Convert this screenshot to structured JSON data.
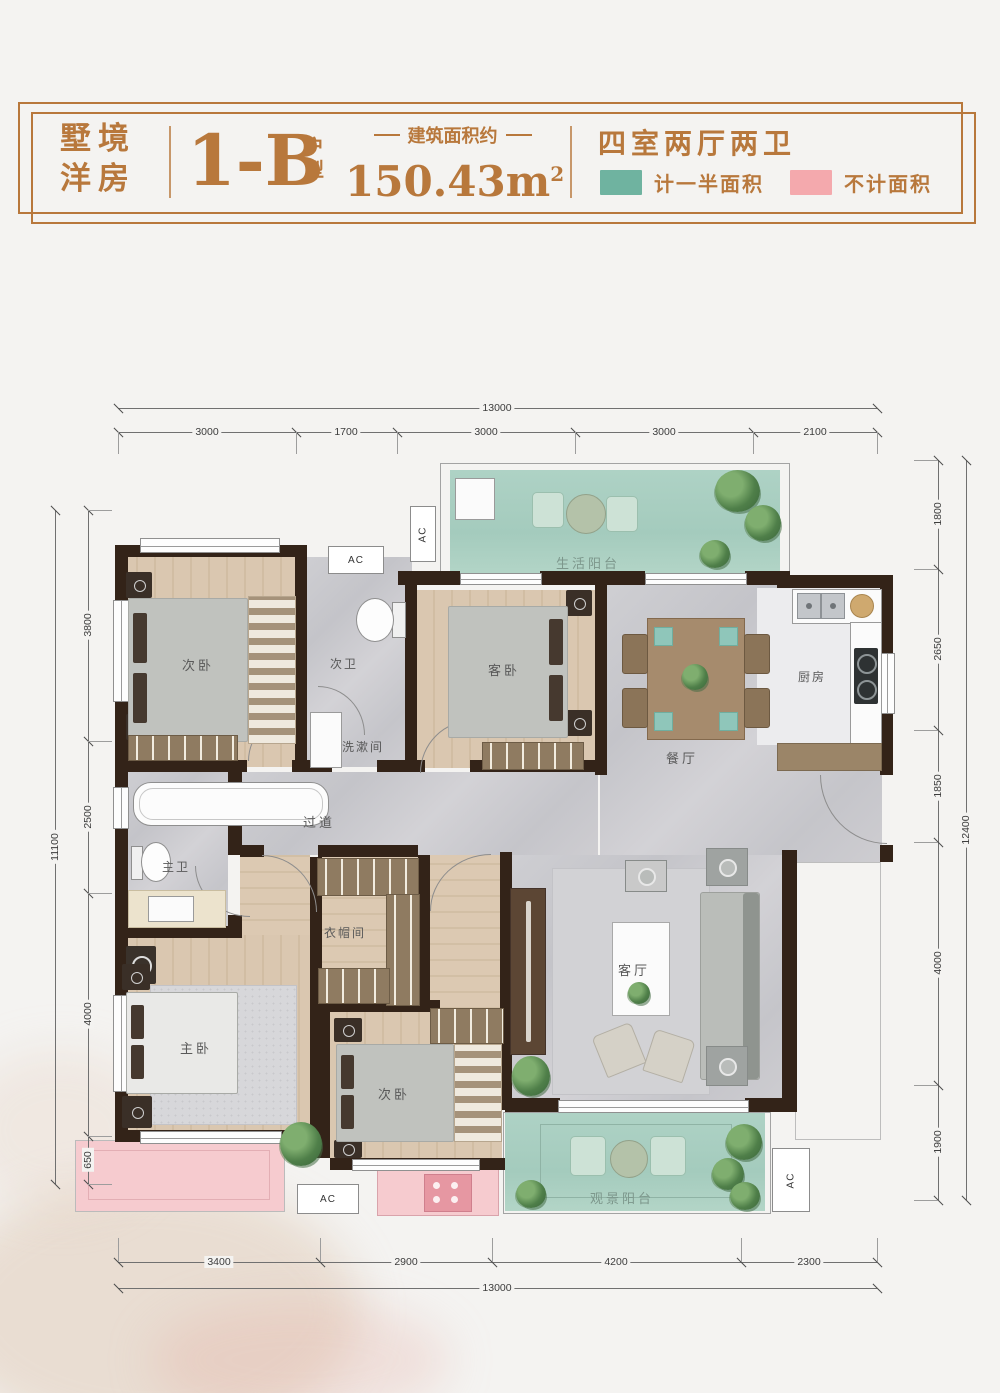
{
  "colors": {
    "accent": "#b8783c",
    "teal": "#6fb3a0",
    "pinkleg": "#f4a9ad",
    "wall": "#332318",
    "pagebg": "#f4f3f1"
  },
  "header": {
    "brand_line1": "墅境",
    "brand_line2": "洋房",
    "unit_code": "1-B",
    "unit_suffix_top": "户",
    "unit_suffix_bottom": "型",
    "area_label": "建筑面积约",
    "area_value": "150.43m",
    "area_sup": "2",
    "layout_title": "四室两厅两卫",
    "legend": [
      {
        "label": "计一半面积",
        "color": "#6fb3a0"
      },
      {
        "label": "不计面积",
        "color": "#f4a9ad"
      }
    ]
  },
  "plan": {
    "labels": {
      "bedroom_top": "次卧",
      "bath_second": "次卫",
      "washroom": "洗漱间",
      "guest_bedroom": "客卧",
      "life_balcony": "生活阳台",
      "dining": "餐厅",
      "kitchen": "厨房",
      "corridor": "过道",
      "master_bath": "主卫",
      "cloakroom": "衣帽间",
      "master_bedroom": "主卧",
      "bedroom_bottom": "次卧",
      "living": "客厅",
      "view_balcony": "观景阳台",
      "ac": "AC"
    },
    "dimensions": {
      "top": {
        "total": "13000",
        "segments": [
          "3000",
          "1700",
          "3000",
          "3000",
          "2100"
        ]
      },
      "bottom": {
        "total": "13000",
        "segments": [
          "3400",
          "2900",
          "4200",
          "2300"
        ]
      },
      "left": {
        "total": "11100",
        "segments": [
          "3800",
          "2500",
          "4000",
          "650"
        ]
      },
      "right": {
        "total": "12400",
        "segments": [
          "1800",
          "2650",
          "1850",
          "4000",
          "1900"
        ]
      }
    }
  }
}
